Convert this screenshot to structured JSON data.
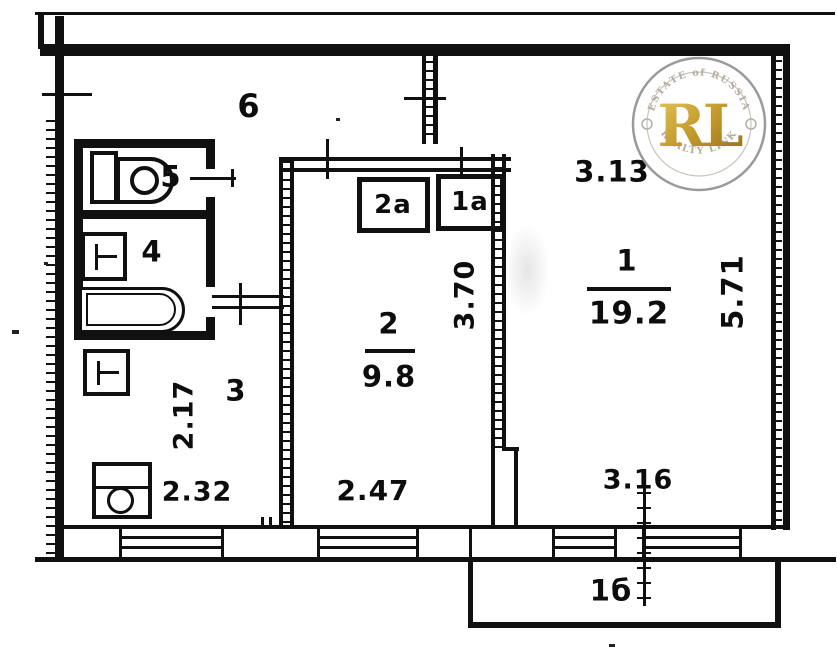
{
  "labels": {
    "hall": "6",
    "wc": "5",
    "bath": "4",
    "kitchen": "3",
    "room2": "2",
    "room1": "1",
    "closet2a": "2а",
    "closet1a": "1а",
    "balcony": "1б"
  },
  "areas": {
    "room1": "19.2",
    "room2": "9.8"
  },
  "dims": {
    "room1_width": "3.13",
    "room1_height": "5.71",
    "room2_height": "3.70",
    "room2_width": "2.47",
    "kitchen_height": "2.17",
    "kitchen_width": "2.32",
    "balcony_width": "3.16"
  },
  "watermark": {
    "top_text": "ESTATE of RUSSIA",
    "monogram": "RL",
    "bottom_text": "REALTY LINK"
  },
  "colors": {
    "ink": "#101010",
    "gold": "#c9a227",
    "ring_gray": "#9a9a9a"
  }
}
